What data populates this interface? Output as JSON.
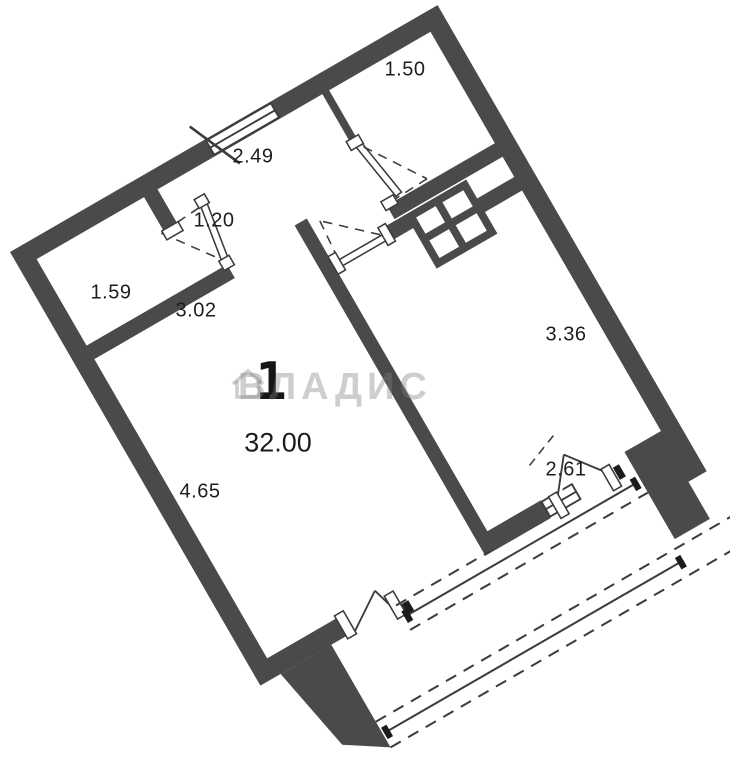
{
  "watermark": {
    "text": "ВЛАДИС",
    "icon": "house-icon",
    "color": "rgba(125,125,128,0.38)"
  },
  "plan": {
    "room_count": "1",
    "total_area": "32.00",
    "dimensions": [
      {
        "id": "bathroom-width",
        "text": "1.50"
      },
      {
        "id": "entry-hall-width",
        "text": "2.49"
      },
      {
        "id": "hall-door-width",
        "text": "1.20"
      },
      {
        "id": "wardrobe-width",
        "text": "1.59"
      },
      {
        "id": "corridor-length",
        "text": "3.02"
      },
      {
        "id": "kitchen-length",
        "text": "3.36"
      },
      {
        "id": "balcony-opening",
        "text": "2.61"
      },
      {
        "id": "living-length",
        "text": "4.65"
      }
    ],
    "colors": {
      "wall": "#4a4a4d",
      "line": "#3c3c3f",
      "background": "#ffffff",
      "anchor": "#1c1c1e"
    }
  }
}
